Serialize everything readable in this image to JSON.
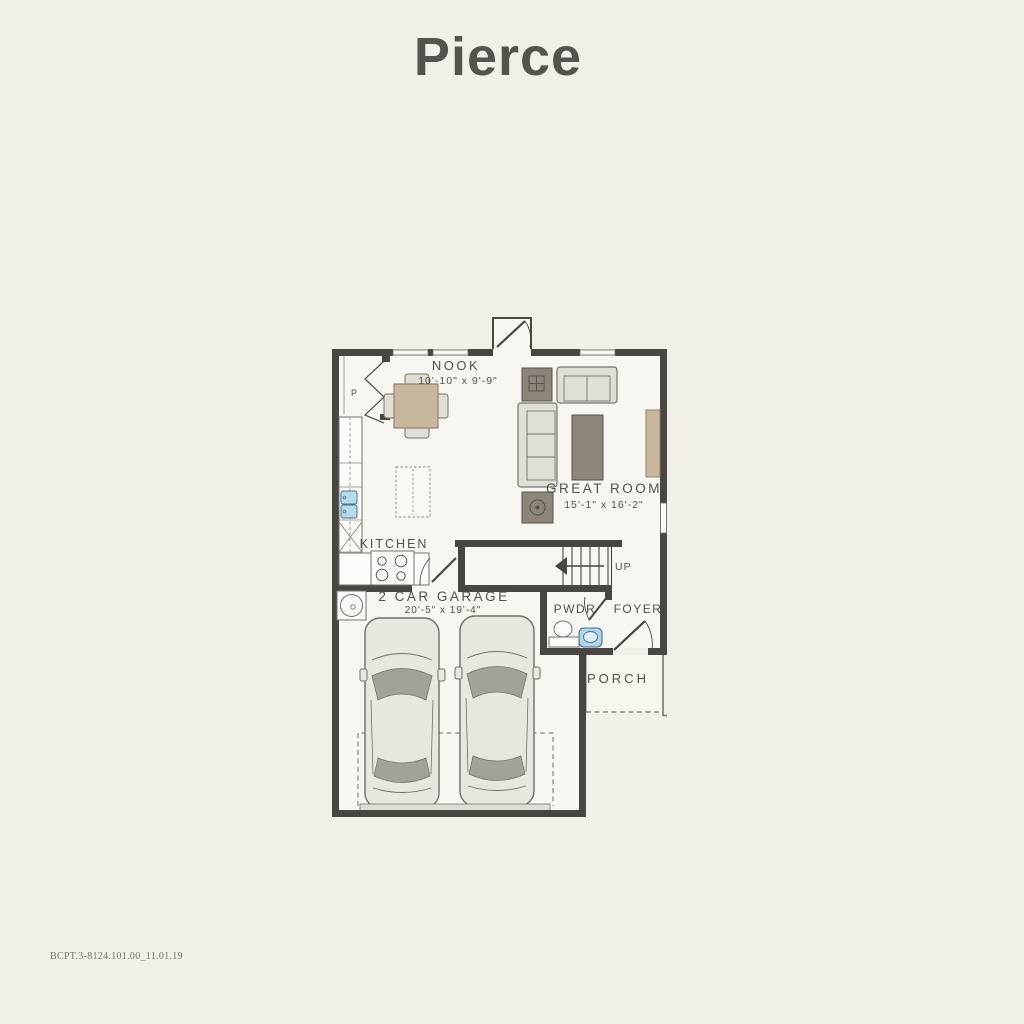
{
  "page": {
    "title": "Pierce",
    "footer_code": "BCPT.3-8124.101.00_11.01.19"
  },
  "floor_plan": {
    "rooms": {
      "nook": {
        "label": "NOOK",
        "dims": "10'-10\" x 9'-9\""
      },
      "great_room": {
        "label": "GREAT ROOM",
        "dims": "15'-1\" x 16'-2\""
      },
      "kitchen": {
        "label": "KITCHEN"
      },
      "garage": {
        "label": "2 CAR GARAGE",
        "dims": "20'-5\" x 19'-4\""
      },
      "powder_room": {
        "label": "PWDR"
      },
      "foyer": {
        "label": "FOYER"
      },
      "porch": {
        "label": "PORCH"
      }
    },
    "annotations": {
      "stairs_direction": "UP",
      "pantry": "P"
    },
    "colors": {
      "background": "#f2efe8",
      "walls": "#474641",
      "furniture_light": "#e0ded6",
      "furniture_dark": "#8b8679",
      "wood_tan": "#c9b79c",
      "plumbing_blue": "#aed6e8",
      "label_text": "#52514a"
    }
  }
}
